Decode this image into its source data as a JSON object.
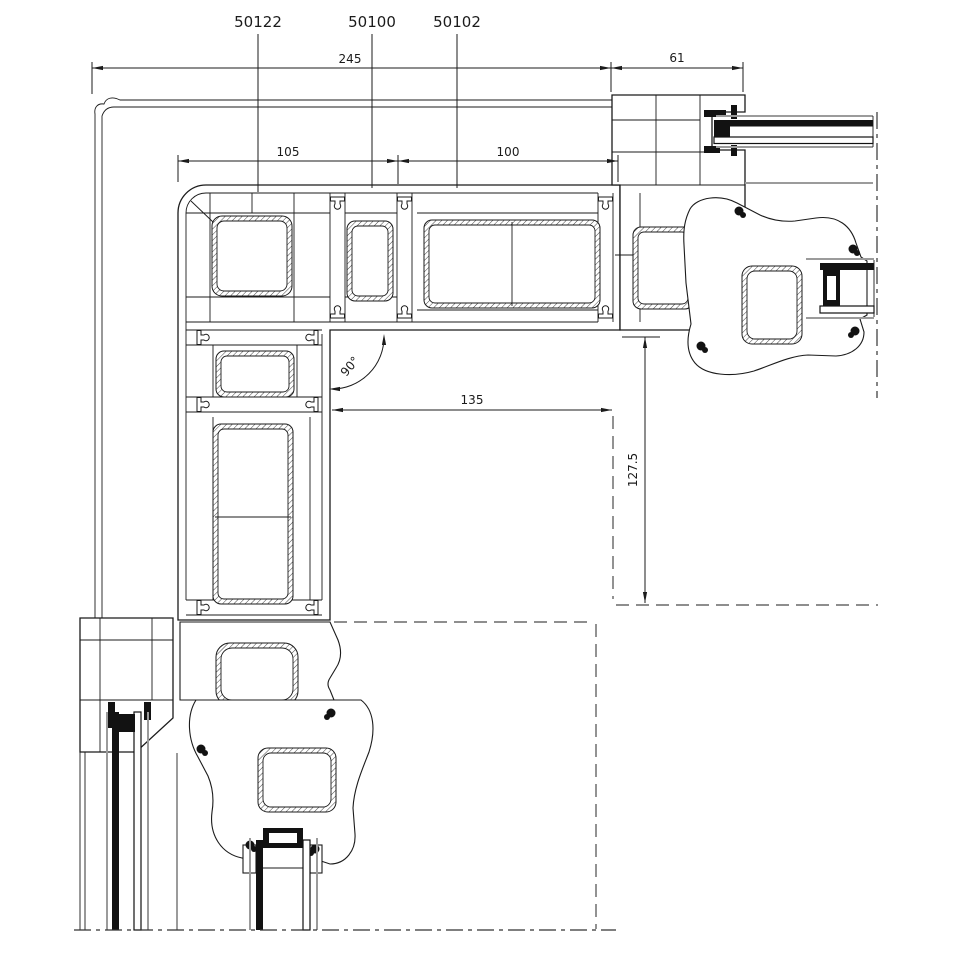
{
  "drawing": {
    "parts": {
      "corner_profile": "50122",
      "coupling_profile": "50100",
      "mullion_profile": "50102"
    },
    "dimensions": {
      "overall_width": "245",
      "frame_depth": "61",
      "corner_width": "105",
      "mullion_width": "100",
      "clear_opening_width": "135",
      "clear_opening_height": "127.5",
      "corner_angle": "90°"
    },
    "colors": {
      "line": "#1b1b1b",
      "glass_pane": "#121212",
      "face_gray": "#9b9b9b",
      "background": "#ffffff"
    }
  }
}
